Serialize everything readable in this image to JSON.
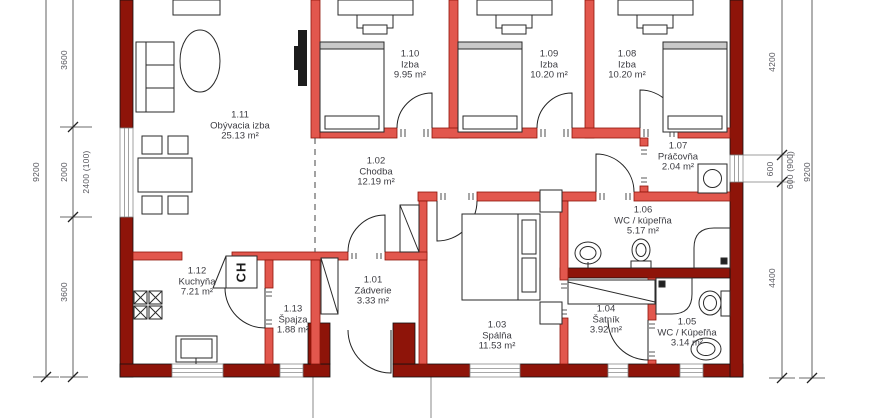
{
  "plan": {
    "rooms": [
      {
        "id": "1.01",
        "name": "Zádverie",
        "area": "3.33 m²"
      },
      {
        "id": "1.02",
        "name": "Chodba",
        "area": "12.19 m²"
      },
      {
        "id": "1.03",
        "name": "Spálňa",
        "area": "11.53 m²"
      },
      {
        "id": "1.04",
        "name": "Šatník",
        "area": "3.92 m²"
      },
      {
        "id": "1.05",
        "name": "WC / Kúpeľňa",
        "area": "3.14 m²"
      },
      {
        "id": "1.06",
        "name": "WC / kúpeľňa",
        "area": "5.17 m²"
      },
      {
        "id": "1.07",
        "name": "Práčovňa",
        "area": "2.04 m²"
      },
      {
        "id": "1.08",
        "name": "Izba",
        "area": "10.20 m²"
      },
      {
        "id": "1.09",
        "name": "Izba",
        "area": "10.20 m²"
      },
      {
        "id": "1.10",
        "name": "Izba",
        "area": "9.95 m²"
      },
      {
        "id": "1.11",
        "name": "Obývacia izba",
        "area": "25.13 m²"
      },
      {
        "id": "1.12",
        "name": "Kuchyňa",
        "area": "7.21 m²"
      },
      {
        "id": "1.13",
        "name": "Špajza",
        "area": "1.88 m²"
      }
    ],
    "dimensions": {
      "left": [
        "9200",
        "3600",
        "2000",
        "2400 (100)",
        "3600"
      ],
      "right": [
        "4200",
        "600",
        "600 (900)",
        "9200",
        "4400"
      ]
    },
    "labels": {
      "fridge": "CH"
    },
    "colors": {
      "exterior_wall": "#8e1409",
      "interior_wall": "#e2574d",
      "dimension_text": "#55555c",
      "room_text": "#3c3c42"
    }
  }
}
